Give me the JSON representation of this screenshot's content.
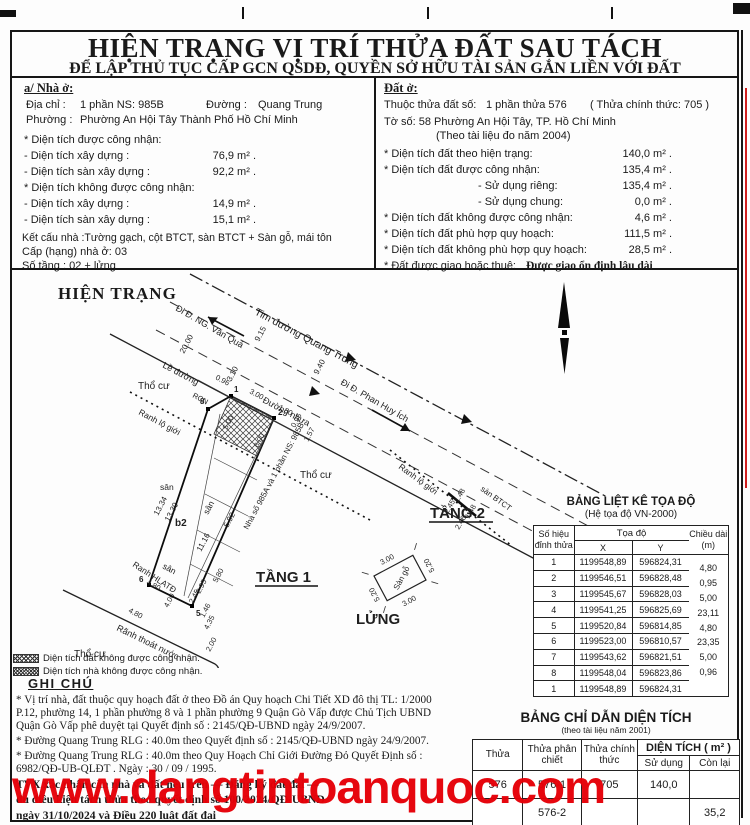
{
  "page": {
    "title": "HIỆN TRẠNG VỊ TRÍ THỬA ĐẤT SAU TÁCH",
    "subtitle": "ĐỂ LẬP THỦ TỤC CẤP GCN QSDĐ, QUYỀN SỞ HỮU TÀI SẢN GẮN LIỀN VỚI ĐẤT"
  },
  "house": {
    "heading": "a/ Nhà ở:",
    "addr_label": "Địa chỉ  :",
    "addr_value": "1 phần NS: 985B",
    "street_label": "Đường :",
    "street_value": "Quang Trung",
    "ward_label": "Phường :",
    "ward_value": "Phường An Hội Tây  Thành Phố Hồ Chí Minh",
    "recognized_heading": "* Diện tích được công nhận:",
    "build_label": "- Diện tích xây dựng  :",
    "build_value": "76,9 m² .",
    "floor_label": "- Diện tích sàn xây dựng  :",
    "floor_value": "92,2 m² .",
    "unrecognized_heading": "* Diện tích không được công nhận:",
    "build2_label": "- Diện tích xây dựng  :",
    "build2_value": "14,9 m² .",
    "floor2_label": "- Diện tích sàn xây dựng  :",
    "floor2_value": "15,1 m² .",
    "structure": "Kết cấu nhà :Tường gạch, cột BTCT, sàn BTCT + Sàn gỗ, mái tôn",
    "grade": "Cấp (hạng) nhà ở:   03",
    "floors": "Số tầng :   02 + lửng"
  },
  "land": {
    "heading": "Đất ở:",
    "plot_label": "Thuộc thửa đất số:",
    "plot_value": "1 phần thửa 576",
    "plot_official": "( Thửa chính thức:  705 )",
    "sheet": "Tờ số: 58   Phường  An Hội Tây, TP. Hồ Chí Minh",
    "doc_year": "(Theo tài liệu đo năm 2004)",
    "cur_label": "* Diện tích đất theo hiện trạng:",
    "cur_value": "140,0  m² .",
    "rec_label": "* Diện tích đất được công nhận:",
    "rec_value": "135,4  m² .",
    "private_label": "- Sử dụng riêng:",
    "private_value": "135,4  m² .",
    "shared_label": "- Sử dụng chung:",
    "shared_value": "0,0  m² .",
    "unrec_label": "* Diện tích đất không được công nhận:",
    "unrec_value": "4,6  m² .",
    "plan_label": "* Diện tích đất phù hợp quy hoạch:",
    "plan_value": "111,5  m² .",
    "noplan_label": "* Diện tích đất không phù hợp quy hoạch:",
    "noplan_value": "28,5  m² .",
    "tenure_label": "* Đất được giao hoặc thuê:",
    "tenure_value": "Được giao ổn định lâu dài"
  },
  "drawing": {
    "title": "HIỆN TRẠNG",
    "road_centerline": "Tim đường Quang Trung",
    "dir_nguyen_van_qua": "Đi Đ. NG. Văn Quá",
    "dir_phan_huy_ich": "Đi Đ. Phan Huy Ích",
    "curb": "Lề  đường",
    "asphalt_road": "Đường nhựa",
    "tho_cu_1": "Thổ cư",
    "tho_cu_2": "Thổ cư",
    "tho_cu_3": "Thổ cư",
    "ranh_lo_gioi_1": "Ranh lộ giới",
    "ranh_lo_gioi_2": "Ranh lộ giới",
    "ranh_hlatd": "Ranh HLATĐ",
    "ranh_thoat_nuoc": "Rãnh thoát nước",
    "rcn": "RCN",
    "neighbor_house": "Nhà số 985A và 1 phần NS: 985B",
    "san_1": "sân",
    "san_2": "sân",
    "san_3": "sân",
    "san_btct": "sàn BTCT",
    "san_go": "Sàn gỗ",
    "b2": "b2",
    "floor1": "TẦNG 1",
    "floor2": "TẦNG 2",
    "mezzanine": "LỬNG",
    "dims": {
      "d2000": "20.00",
      "d915": "9.15",
      "d310": "3.10",
      "d940": "9.40",
      "d096": "0.96",
      "d300": "3.00",
      "d180": "1.80",
      "d095": "0.95",
      "d157": "1.57",
      "d500": "5.00",
      "d600": "6.00",
      "d1334": "13.34",
      "d1330": "13.30",
      "d1116": "11.16",
      "d592": "5.92",
      "d580": "5.80",
      "d295": "2.95",
      "d245": "2.45",
      "d435": "4.35",
      "d146": "1.46",
      "d480a": "4.80",
      "d480b": "4.80",
      "d400": "4.00",
      "d200": "2.00",
      "d245b": "2.45",
      "d148a": "1.48",
      "d246": "2.46",
      "d148b": "1.48",
      "d300l": "3.00",
      "d520a": "5.20",
      "d520b": "5.20",
      "d300m": "3.00"
    },
    "vertices": {
      "v1": "1",
      "v2": "2",
      "v8": "8",
      "v5": "5",
      "v6": "6"
    }
  },
  "legend": {
    "items": [
      {
        "text": "Diện tích đất không được công nhận."
      },
      {
        "text": "Diện tích nhà không được công nhận."
      }
    ]
  },
  "notes": {
    "heading": "GHI CHÚ",
    "note1": "* Vị trí nhà, đất thuộc quy hoạch đất ở theo Đồ án Quy hoạch Chi Tiết XD đô thị TL: 1/2000 P.12, phường 14, 1 phần phường 8 và 1 phần phường 9 Quận Gò Vấp được Chủ Tịch UBND Quận Gò Vấp phê duyệt tại Quyết định số : 2145/QĐ-UBND ngày 24/9/2007.",
    "note2": "* Đường Quang Trung RLG : 40.0m theo Quyết định số : 2145/QĐ-UBND ngày 24/9/2007.",
    "note3": "* Đường Quang Trung RLG : 40.0m theo Quy Hoạch Chỉ Giới Đường Đỏ Quyết Định số : 6982/QĐ-UB-QLĐT . Ngày : 30 / 09 / 1995.",
    "bold1": "TVX xác nhận căn nhà và đất nêu trên — Đăng ký đất đai —",
    "bold2": "đủ điều kiện tách thửa theo quyết định số 100/2024/QĐ-UBND",
    "bold3": "ngày 31/10/2024 và Điều 220 luật đất đai"
  },
  "coord_table": {
    "title": "BẢNG LIỆT KÊ TỌA ĐỘ",
    "subtitle": "(Hệ tọa độ VN-2000)",
    "col_point_1": "Số hiệu",
    "col_point_2": "đỉnh thửa",
    "col_coord": "Tọa độ",
    "col_x": "X",
    "col_y": "Y",
    "col_len_1": "Chiều dài",
    "col_len_2": "(m)",
    "rows": [
      {
        "id": "1",
        "x": "1199548,89",
        "y": "596824,31"
      },
      {
        "id": "2",
        "x": "1199546,51",
        "y": "596828,48"
      },
      {
        "id": "3",
        "x": "1199545,67",
        "y": "596828,03"
      },
      {
        "id": "4",
        "x": "1199541,25",
        "y": "596825,69"
      },
      {
        "id": "5",
        "x": "1199520,84",
        "y": "596814,85"
      },
      {
        "id": "6",
        "x": "1199523,00",
        "y": "596810,57"
      },
      {
        "id": "7",
        "x": "1199543,62",
        "y": "596821,51"
      },
      {
        "id": "8",
        "x": "1199548,04",
        "y": "596823,86"
      },
      {
        "id": "1",
        "x": "1199548,89",
        "y": "596824,31"
      }
    ],
    "lengths": [
      "4,80",
      "0,95",
      "5,00",
      "23,11",
      "4,80",
      "23,35",
      "5,00",
      "0,96"
    ]
  },
  "area_table": {
    "title": "BẢNG CHỈ DẪN DIỆN TÍCH",
    "subtitle": "(theo tài liệu năm 2001)",
    "col_plot": "Thửa",
    "col_sub": "Thửa phân chiết",
    "col_official": "Thửa chính thức",
    "col_area": "DIỆN TÍCH ( m² )",
    "col_used": "Sử dụng",
    "col_remain": "Còn lại",
    "rows": [
      {
        "plot": "576",
        "sub": "576-1",
        "official": "705",
        "used": "140,0",
        "remain": ""
      },
      {
        "plot": "",
        "sub": "576-2",
        "official": "",
        "used": "",
        "remain": "35,2"
      }
    ]
  },
  "watermark": {
    "text": "www.dangtintoanquoc.com",
    "color": "#e60008"
  }
}
